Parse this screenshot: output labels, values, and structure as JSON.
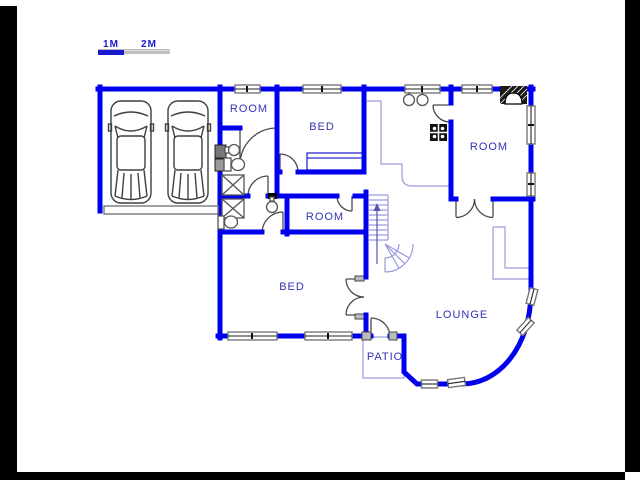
{
  "scale_bar": {
    "one_m": "1M",
    "two_m": "2M"
  },
  "labels": {
    "room_top": "ROOM",
    "bed_top": "BED",
    "room_right": "ROOM",
    "room_middle": "ROOM",
    "bed_lower": "BED",
    "lounge": "LOUNGE",
    "patio": "PATIO"
  },
  "colors": {
    "wall_blue": "#0000ee",
    "label_blue": "#3232b4",
    "thin_line": "#9a9ade",
    "scale_blue": "#1818cc",
    "scale_gray": "#c0c0c0",
    "letterbox_black": "#000000"
  }
}
